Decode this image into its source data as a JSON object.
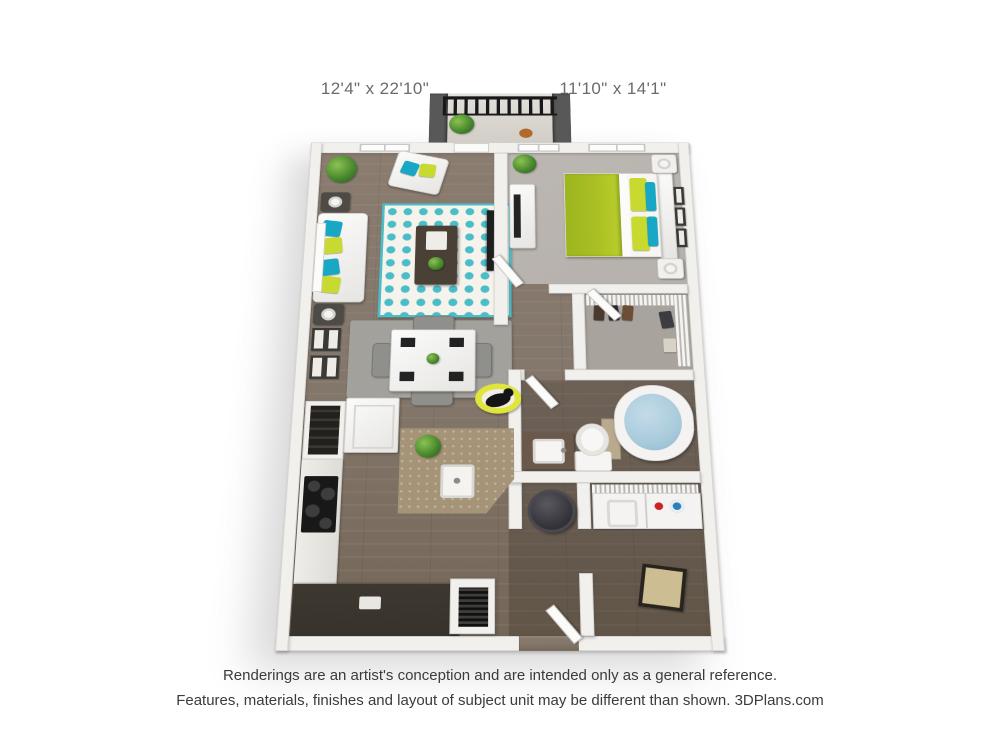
{
  "dimensions": {
    "living_room": "12'4\" x 22'10\"",
    "bedroom": "11'10\" x 14'1\""
  },
  "footer": {
    "line1": "Renderings are an artist's conception and are intended only as a general reference.",
    "line2": "Features, materials, finishes and layout of subject unit may be different than shown. 3DPlans.com"
  },
  "palette": {
    "lime": "#aabf23",
    "lime-bright": "#c8da2f",
    "teal": "#18a7c4",
    "rug-teal": "#4abdc9",
    "floor-wood": "#83766a",
    "floor-wood-dark": "#6e6157",
    "carpet": "#b6b1ac",
    "wall-white": "#f1f0ed",
    "balcony-gray": "#585858",
    "island-tan": "#a59478",
    "counter-dark": "#37322b",
    "tub-water": "#a9cbdc",
    "pet-bed-yellow": "#dfe53a",
    "label-text": "#6b6b6b",
    "footer-text": "#3b3b3b"
  }
}
